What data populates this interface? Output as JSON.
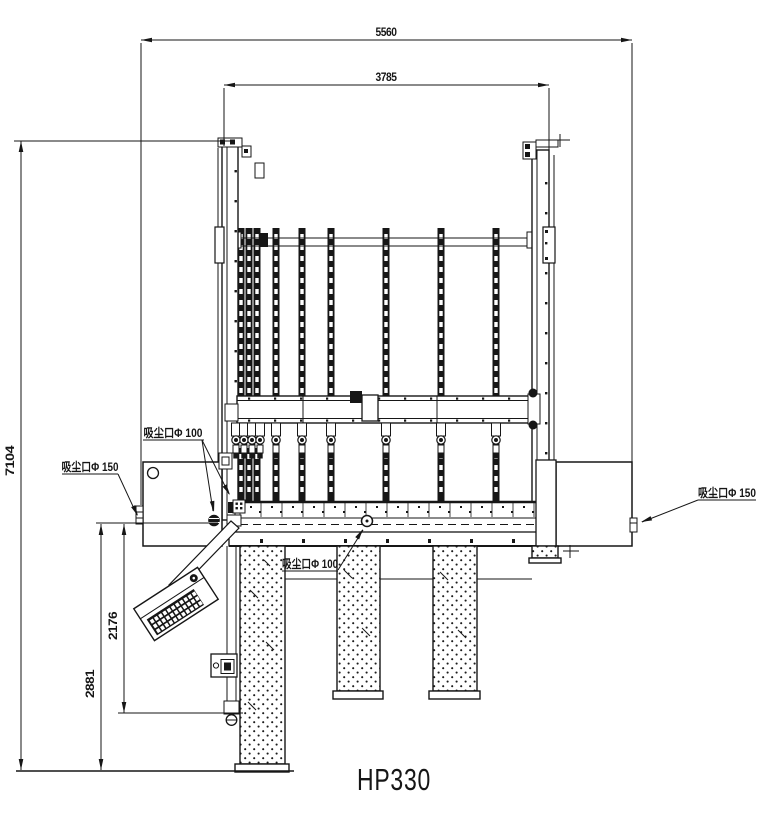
{
  "drawing": {
    "title": "HP330",
    "dimensions": {
      "overall_width": "5560",
      "frame_width": "3785",
      "total_height": "7104",
      "base_to_ground": "2881",
      "column_height": "2176"
    },
    "callouts": {
      "dust_port_100_upper": "吸尘口Φ 100",
      "dust_port_100_lower": "吸尘口Φ 100",
      "dust_port_150_left": "吸尘口Φ 150",
      "dust_port_150_right": "吸尘口Φ 150"
    },
    "colors": {
      "line": "#161616",
      "background": "#ffffff"
    }
  }
}
